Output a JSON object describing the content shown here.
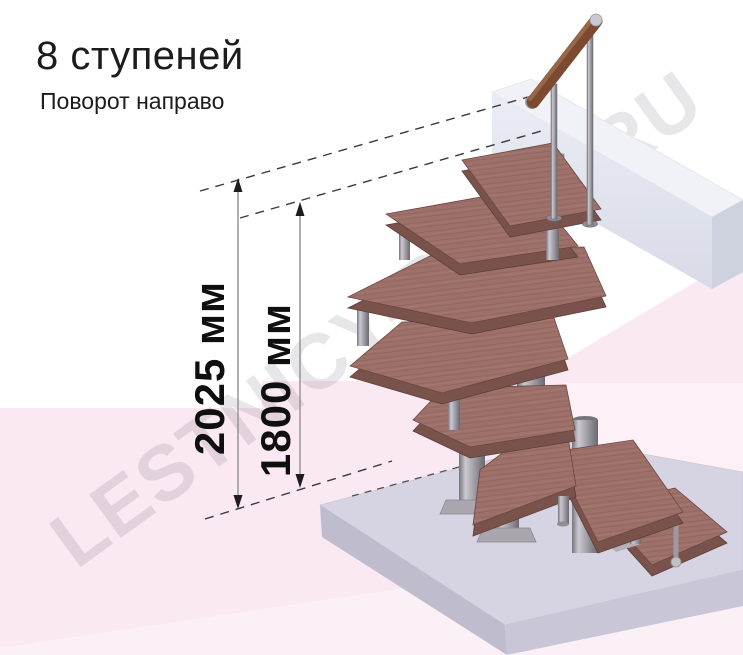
{
  "header": {
    "title": "8 ступеней",
    "subtitle": "Поворот направо"
  },
  "dimensions": {
    "total": {
      "label": "2025 мм",
      "value_mm": 2025
    },
    "flight": {
      "label": "1800 мм",
      "value_mm": 1800
    }
  },
  "watermark": {
    "text": "LESTNICY-PROF.RU"
  },
  "scene": {
    "steps_count": 8,
    "turn_direction": "направо"
  },
  "colors": {
    "tread_wood": "#9d716a",
    "tread_edge": "#7a524c",
    "metal_gray": "#a5a2aa",
    "handrail_wood": "#7c4a31",
    "floor_pink": "#fae8f2",
    "floor_pink_light": "#fcf0f7",
    "base_slab": "#d6d3e2",
    "landing_beam": "#e9ecf4",
    "dimension_text": "#0f0f0f",
    "title_text": "#1c1c1c",
    "watermark_gray": "#6a6278"
  }
}
